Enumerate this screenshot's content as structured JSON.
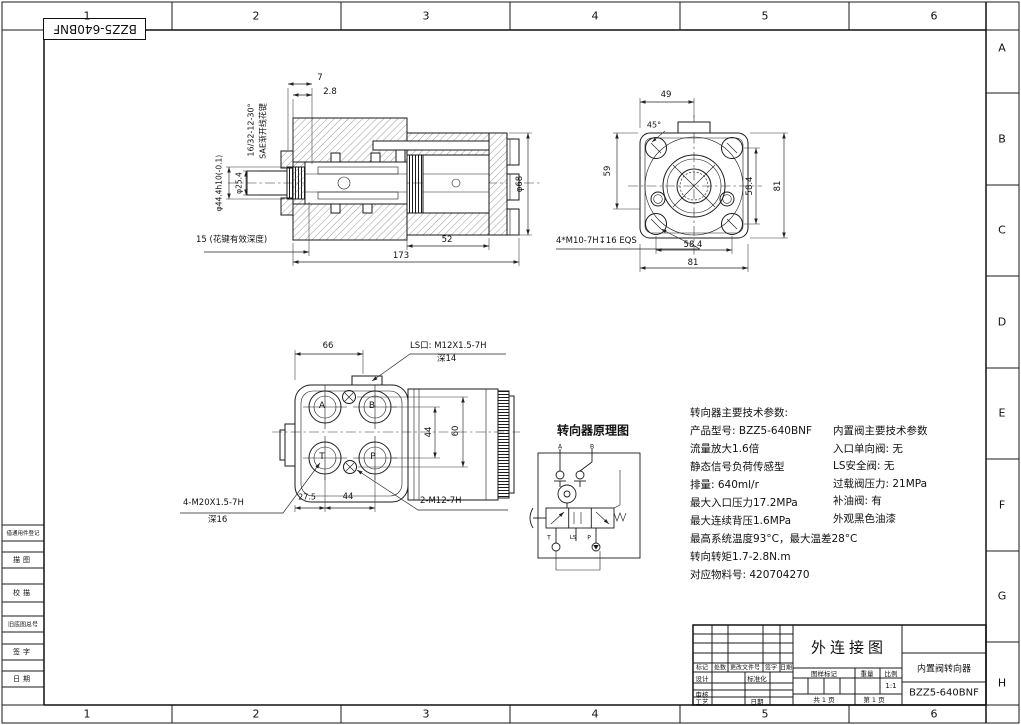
{
  "page": {
    "paper_color": "#ffffff",
    "ink_color": "#1a1a1a"
  },
  "frame": {
    "columns": [
      "1",
      "2",
      "3",
      "4",
      "5",
      "6"
    ],
    "rows": [
      "A",
      "B",
      "C",
      "D",
      "E",
      "F",
      "G",
      "H"
    ],
    "corner_part_no": "BZZS-640BNF-rotated",
    "corner_part_no_text": "BZZ5-640BNF"
  },
  "section_view": {
    "dim_7": "7",
    "dim_2_8": "2.8",
    "spline_note_line1": "16/32-12-30°",
    "spline_note_line2": "SAE渐开线花键",
    "dim_shaft": "φ44.4h10(-0.1)",
    "dim_25_4": "φ25.4",
    "spline_depth_note": "15 (花键有效深度)",
    "dim_52": "52",
    "dim_173": "173",
    "dim_68": "φ68"
  },
  "end_view": {
    "dim_49": "49",
    "dim_45deg": "45°",
    "dim_59": "59",
    "dim_58_4_v": "58.4",
    "dim_81_v": "81",
    "dim_58_4_h": "58.4",
    "dim_81_h": "81",
    "bolt_note": "4*M10-7H↧16 EQS"
  },
  "port_view": {
    "dim_66": "66",
    "ls_note_line1": "LS口: M12X1.5-7H",
    "ls_note_line2": "深14",
    "port_a": "A",
    "port_b": "B",
    "port_t": "T",
    "port_p": "P",
    "dim_44_v": "44",
    "dim_60_v": "60",
    "dim_27_5": "27.5",
    "dim_44_h": "44",
    "main_port_note_line1": "4-M20X1.5-7H",
    "main_port_note_line2": "深16",
    "small_port_note": "2-M12-7H"
  },
  "schematic": {
    "title": "转向器原理图",
    "label_a": "A",
    "label_b": "B",
    "label_t": "T",
    "label_ls": "LS",
    "label_p": "P"
  },
  "params_main": {
    "lines": [
      "转向器主要技术参数:",
      "产品型号: BZZ5-640BNF",
      "流量放大1.6倍",
      "静态信号负荷传感型",
      "排量: 640ml/r",
      "最大入口压力17.2MPa",
      "最大连续背压1.6MPa",
      "最高系统温度93°C，最大温差28°C",
      "转向转矩1.7-2.8N.m",
      "对应物料号: 420704270"
    ]
  },
  "params_valve": {
    "lines": [
      "内置阀主要技术参数",
      "入口单向阀: 无",
      "LS安全阀: 无",
      "过载阀压力: 21MPa",
      "补油阀: 有",
      "外观黑色油漆"
    ]
  },
  "title_block": {
    "drawing_title": "外连接图",
    "product_name": "内置阀转向器",
    "part_number": "BZZ5-640BNF",
    "rev_headers": [
      "标记",
      "处数",
      "更改文件号",
      "签字",
      "日期"
    ],
    "design_label": "设计",
    "standard_label": "标准化",
    "check_label": "审核",
    "process_label": "工艺",
    "date_label": "日期",
    "mark_label": "图样标记",
    "weight_label": "重量",
    "scale_label": "比例",
    "scale_value": "1:1",
    "sheet_total": "共 1 页",
    "sheet_no": "第 1 页"
  },
  "margin_block": {
    "items": [
      "借通用件登记",
      "描图",
      "校描",
      "旧底图总号",
      "签字",
      "日期"
    ]
  }
}
